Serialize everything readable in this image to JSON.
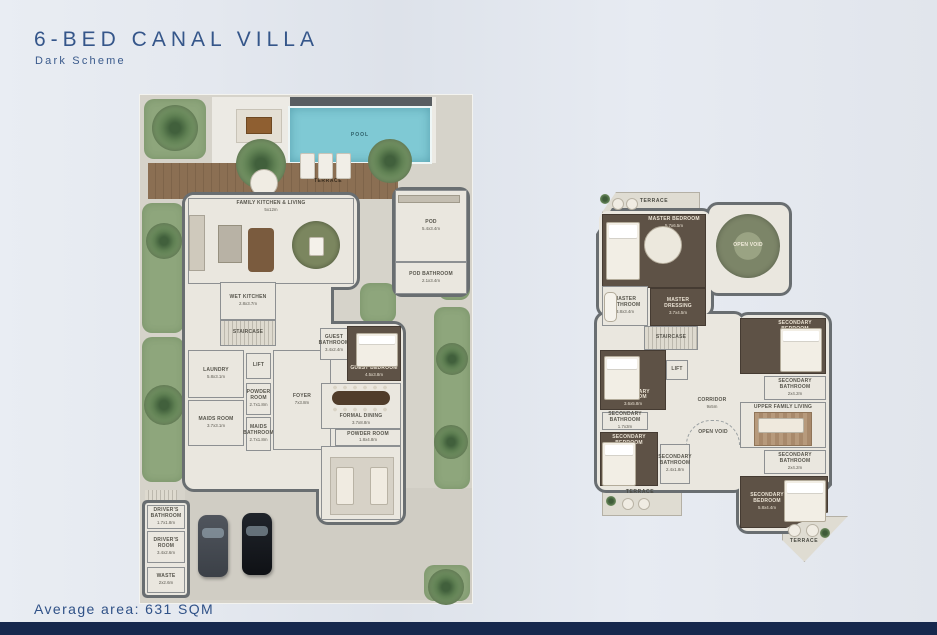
{
  "header": {
    "title": "6-BED CANAL VILLA",
    "subtitle": "Dark Scheme"
  },
  "footer": {
    "average_area": "Average area: 631 SQM"
  },
  "colors": {
    "accent_navy": "#35568a",
    "footer_bar": "#16284d",
    "pool": "#7fc9d4",
    "dark_room": "#5e5246",
    "deck_wood": "#8b6f53",
    "grass": "#8ea67c"
  },
  "ground_floor": {
    "outdoor": {
      "pool": "POOL",
      "terrace": "TERRACE"
    },
    "rooms": {
      "family_kitchen_living": {
        "name": "FAMILY KITCHEN & LIVING",
        "dims": "5x12m"
      },
      "pod": {
        "name": "POD",
        "dims": "5.4x3.4m"
      },
      "pod_bathroom": {
        "name": "POD BATHROOM",
        "dims": "2.1x3.4m"
      },
      "wet_kitchen": {
        "name": "WET KITCHEN",
        "dims": "2.8x3.7m"
      },
      "staircase": {
        "name": "STAIRCASE",
        "dims": ""
      },
      "laundry": {
        "name": "LAUNDRY",
        "dims": "5.8x3.1m"
      },
      "lift": {
        "name": "LIFT",
        "dims": ""
      },
      "powder_room_1": {
        "name": "POWDER ROOM",
        "dims": "2.7x1.8m"
      },
      "maids_room": {
        "name": "MAIDS ROOM",
        "dims": "3.7x3.1m"
      },
      "maids_bathroom": {
        "name": "MAIDS BATHROOM",
        "dims": "2.7x1.8m"
      },
      "foyer": {
        "name": "FOYER",
        "dims": "7x3.8m"
      },
      "guest_bathroom": {
        "name": "GUEST BATHROOM",
        "dims": "3.4x2.4m"
      },
      "guest_bedroom": {
        "name": "GUEST BEDROOM",
        "dims": "4.5x3.8m"
      },
      "formal_dining": {
        "name": "FORMAL DINING",
        "dims": "3.7x8.8m"
      },
      "powder_room_2": {
        "name": "POWDER ROOM",
        "dims": "1.8x4.8m"
      },
      "formal_living": {
        "name": "FORMAL LIVING",
        "dims": "5.7x6.8m"
      },
      "drivers_bathroom": {
        "name": "DRIVER'S BATHROOM",
        "dims": "1.7x1.8m"
      },
      "drivers_room": {
        "name": "DRIVER'S ROOM",
        "dims": "3.4x2.6m"
      },
      "waste": {
        "name": "WASTE",
        "dims": "2x2.6m"
      }
    }
  },
  "upper_floor": {
    "rooms": {
      "terrace_master": {
        "name": "TERRACE",
        "dims": ""
      },
      "master_bedroom": {
        "name": "MASTER BEDROOM",
        "dims": "5.7x6.5m"
      },
      "open_void_main": {
        "name": "OPEN VOID",
        "dims": ""
      },
      "master_bathroom": {
        "name": "MASTER BATHROOM",
        "dims": "3.8x3.4m"
      },
      "master_dressing": {
        "name": "MASTER DRESSING",
        "dims": "3.7x4.5m"
      },
      "staircase": {
        "name": "STAIRCASE",
        "dims": ""
      },
      "lift": {
        "name": "LIFT",
        "dims": ""
      },
      "corridor": {
        "name": "CORRIDOR",
        "dims": "9x5m"
      },
      "open_void_corridor": {
        "name": "OPEN VOID",
        "dims": ""
      },
      "secondary_bedroom_1": {
        "name": "SECONDARY BEDROOM",
        "dims": "3.6x5.8m"
      },
      "secondary_bathroom_1": {
        "name": "SECONDARY BATHROOM",
        "dims": "1.7x3m"
      },
      "secondary_bedroom_2": {
        "name": "SECONDARY BEDROOM",
        "dims": "3.8x4.4m"
      },
      "secondary_bathroom_2": {
        "name": "SECONDARY BATHROOM",
        "dims": "2x4.2m"
      },
      "upper_family_living": {
        "name": "UPPER FAMILY LIVING",
        "dims": "5.2x5m"
      },
      "secondary_bathroom_3": {
        "name": "SECONDARY BATHROOM",
        "dims": "2x4.2m"
      },
      "secondary_bedroom_3": {
        "name": "SECONDARY BEDROOM",
        "dims": "6x3.8m"
      },
      "secondary_bathroom_4": {
        "name": "SECONDARY BATHROOM",
        "dims": "2.4x1.8m"
      },
      "secondary_bedroom_4": {
        "name": "SECONDARY BEDROOM",
        "dims": "5.8x4.4m"
      },
      "terrace_left": {
        "name": "TERRACE",
        "dims": ""
      },
      "terrace_right": {
        "name": "TERRACE",
        "dims": ""
      }
    }
  }
}
